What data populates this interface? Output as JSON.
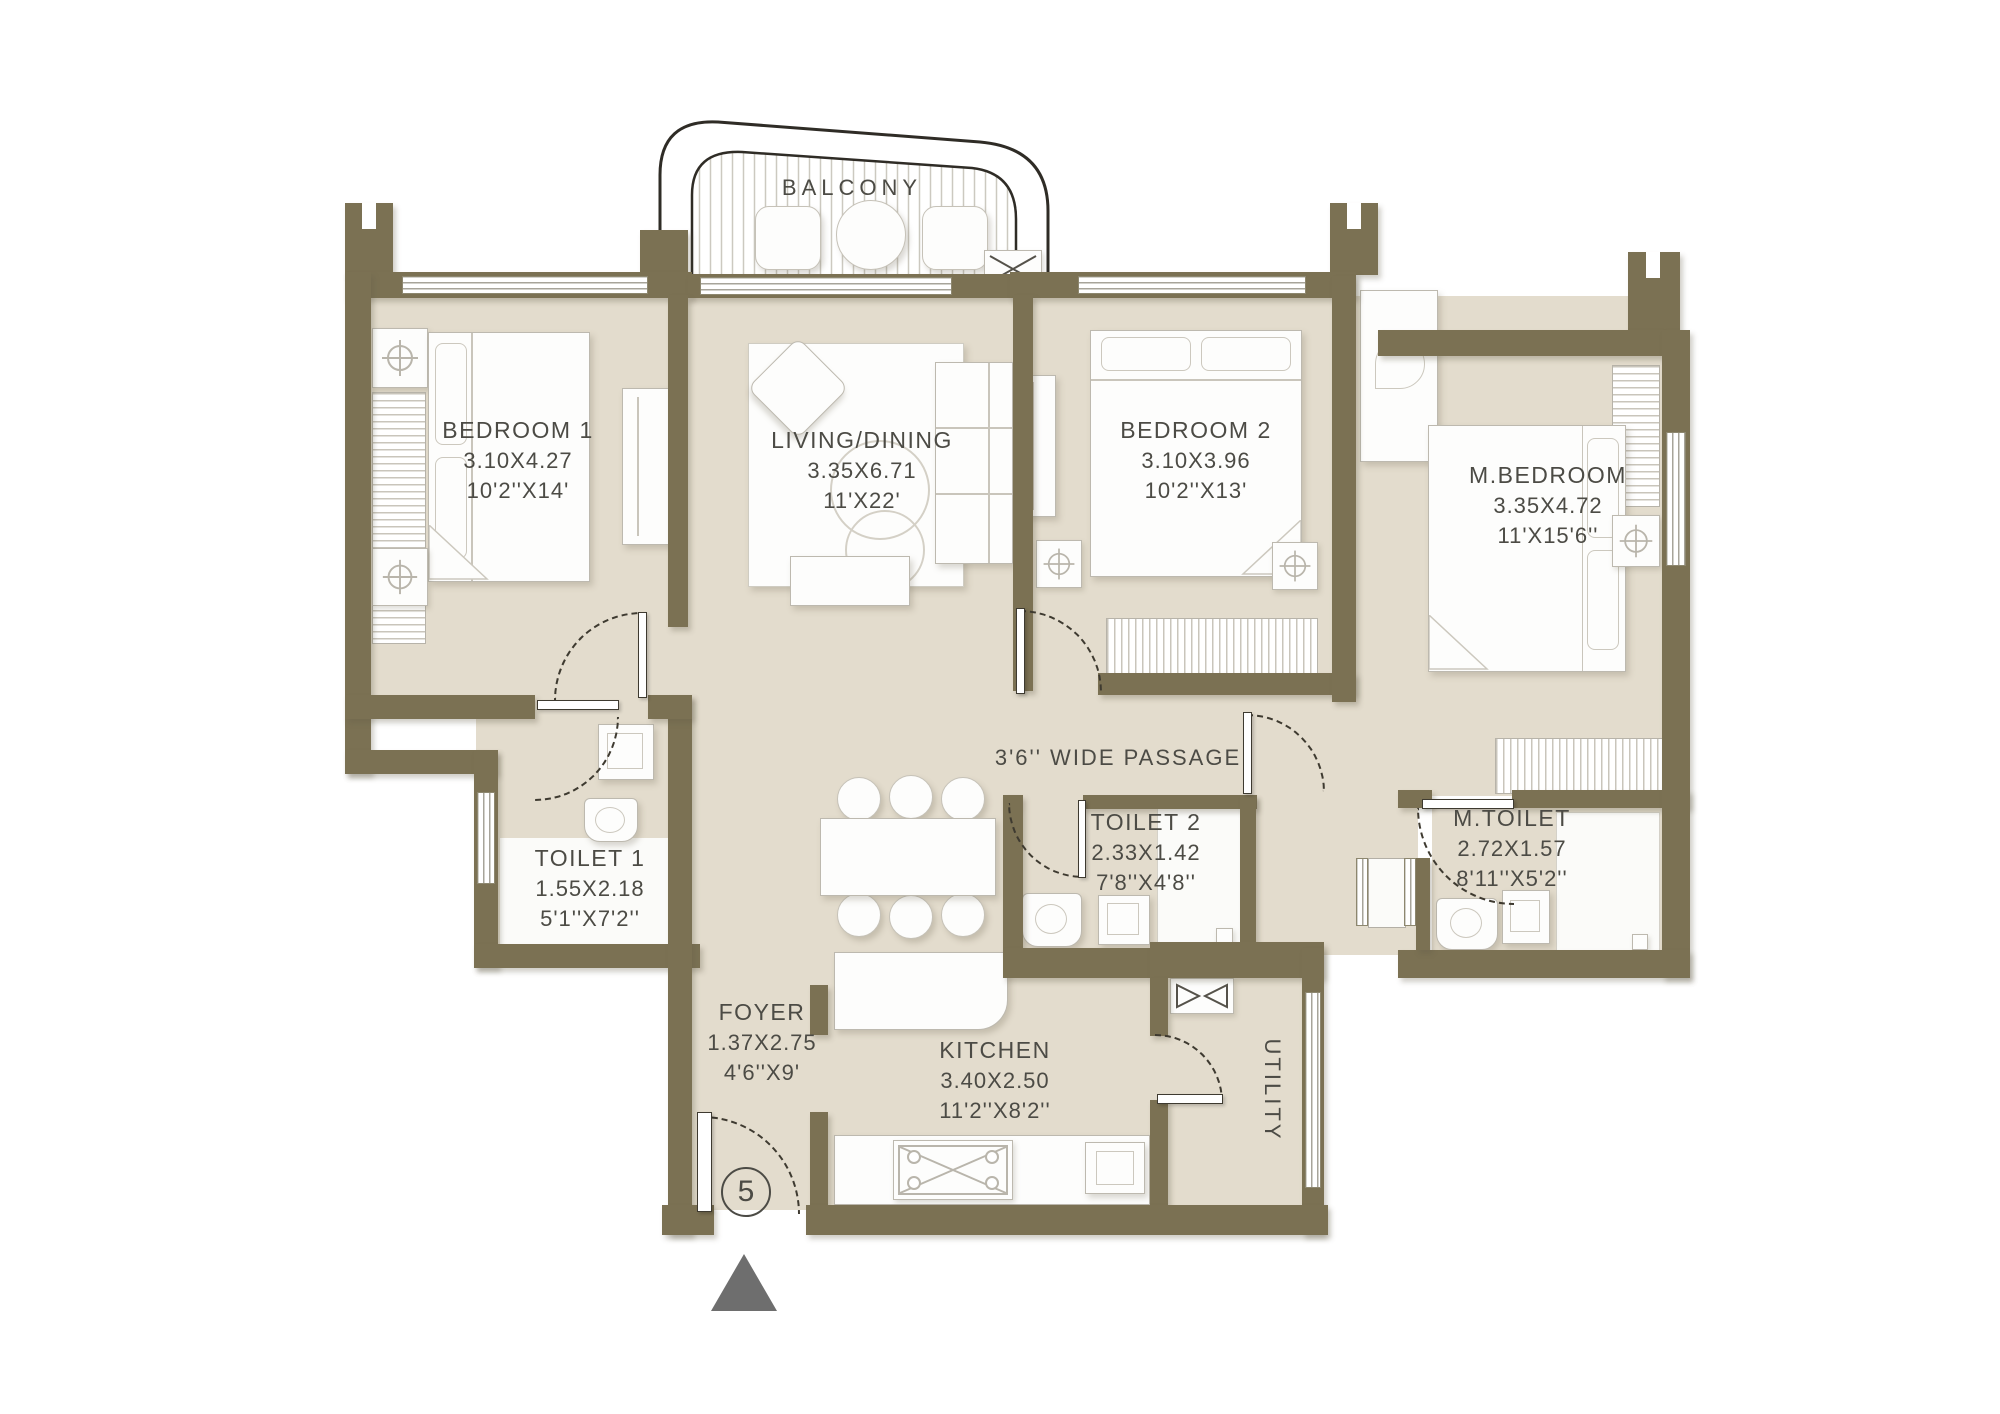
{
  "labels": {
    "balcony": "BALCONY",
    "passage": "3'6'' WIDE PASSAGE",
    "utility": "UTILITY",
    "unit_number": "5"
  },
  "rooms": {
    "bedroom1": {
      "name": "BEDROOM 1",
      "dim_m": "3.10X4.27",
      "dim_ft": "10'2''X14'"
    },
    "living": {
      "name": "LIVING/DINING",
      "dim_m": "3.35X6.71",
      "dim_ft": "11'X22'"
    },
    "bedroom2": {
      "name": "BEDROOM 2",
      "dim_m": "3.10X3.96",
      "dim_ft": "10'2''X13'"
    },
    "master_bedroom": {
      "name": "M.BEDROOM",
      "dim_m": "3.35X4.72",
      "dim_ft": "11'X15'6''"
    },
    "toilet1": {
      "name": "TOILET 1",
      "dim_m": "1.55X2.18",
      "dim_ft": "5'1''X7'2''"
    },
    "toilet2": {
      "name": "TOILET 2",
      "dim_m": "2.33X1.42",
      "dim_ft": "7'8''X4'8''"
    },
    "master_toilet": {
      "name": "M.TOILET",
      "dim_m": "2.72X1.57",
      "dim_ft": "8'11''X5'2''"
    },
    "foyer": {
      "name": "FOYER",
      "dim_m": "1.37X2.75",
      "dim_ft": "4'6''X9'"
    },
    "kitchen": {
      "name": "KITCHEN",
      "dim_m": "3.40X2.50",
      "dim_ft": "11'2''X8'2''"
    }
  },
  "colors": {
    "wall": "#7b7153",
    "floor": "#e3dccd",
    "text": "#4c4b45",
    "entry_arrow": "#6e6e6e"
  }
}
